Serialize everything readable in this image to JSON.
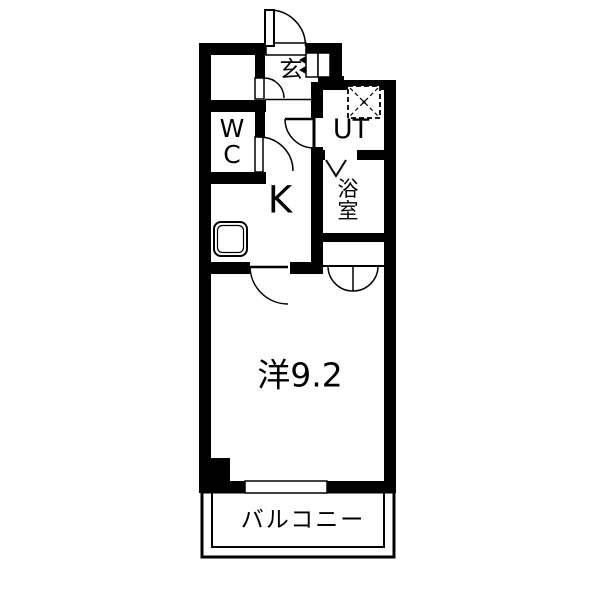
{
  "floorplan": {
    "type": "apartment-floor-plan",
    "rooms": {
      "entrance_label": "玄",
      "toilet_label": "WC",
      "utility_label": "UT",
      "bathroom_label": "浴室",
      "kitchen_label": "K",
      "main_room_label": "洋9.2",
      "balcony_label": "バルコニー"
    },
    "colors": {
      "wall": "#000000",
      "floor": "#ffffff",
      "line": "#000000"
    },
    "symbols": {
      "entrance_door": "swing-door-arc",
      "closet_door": "swing-door-arc",
      "wc_door": "swing-door-arc",
      "ut_door": "swing-door-arc",
      "main_room_door": "swing-door-arc",
      "closet_double_door": "double-swing-arc",
      "bathroom_door": "folding-door-v",
      "washing_machine": "dashed-square-x",
      "kitchen_sink": "rounded-rect",
      "shoe_cabinet": "two-cells-with-arrows",
      "balcony_window": "wall-opening",
      "balcony_rail": "double-line-rect"
    }
  }
}
